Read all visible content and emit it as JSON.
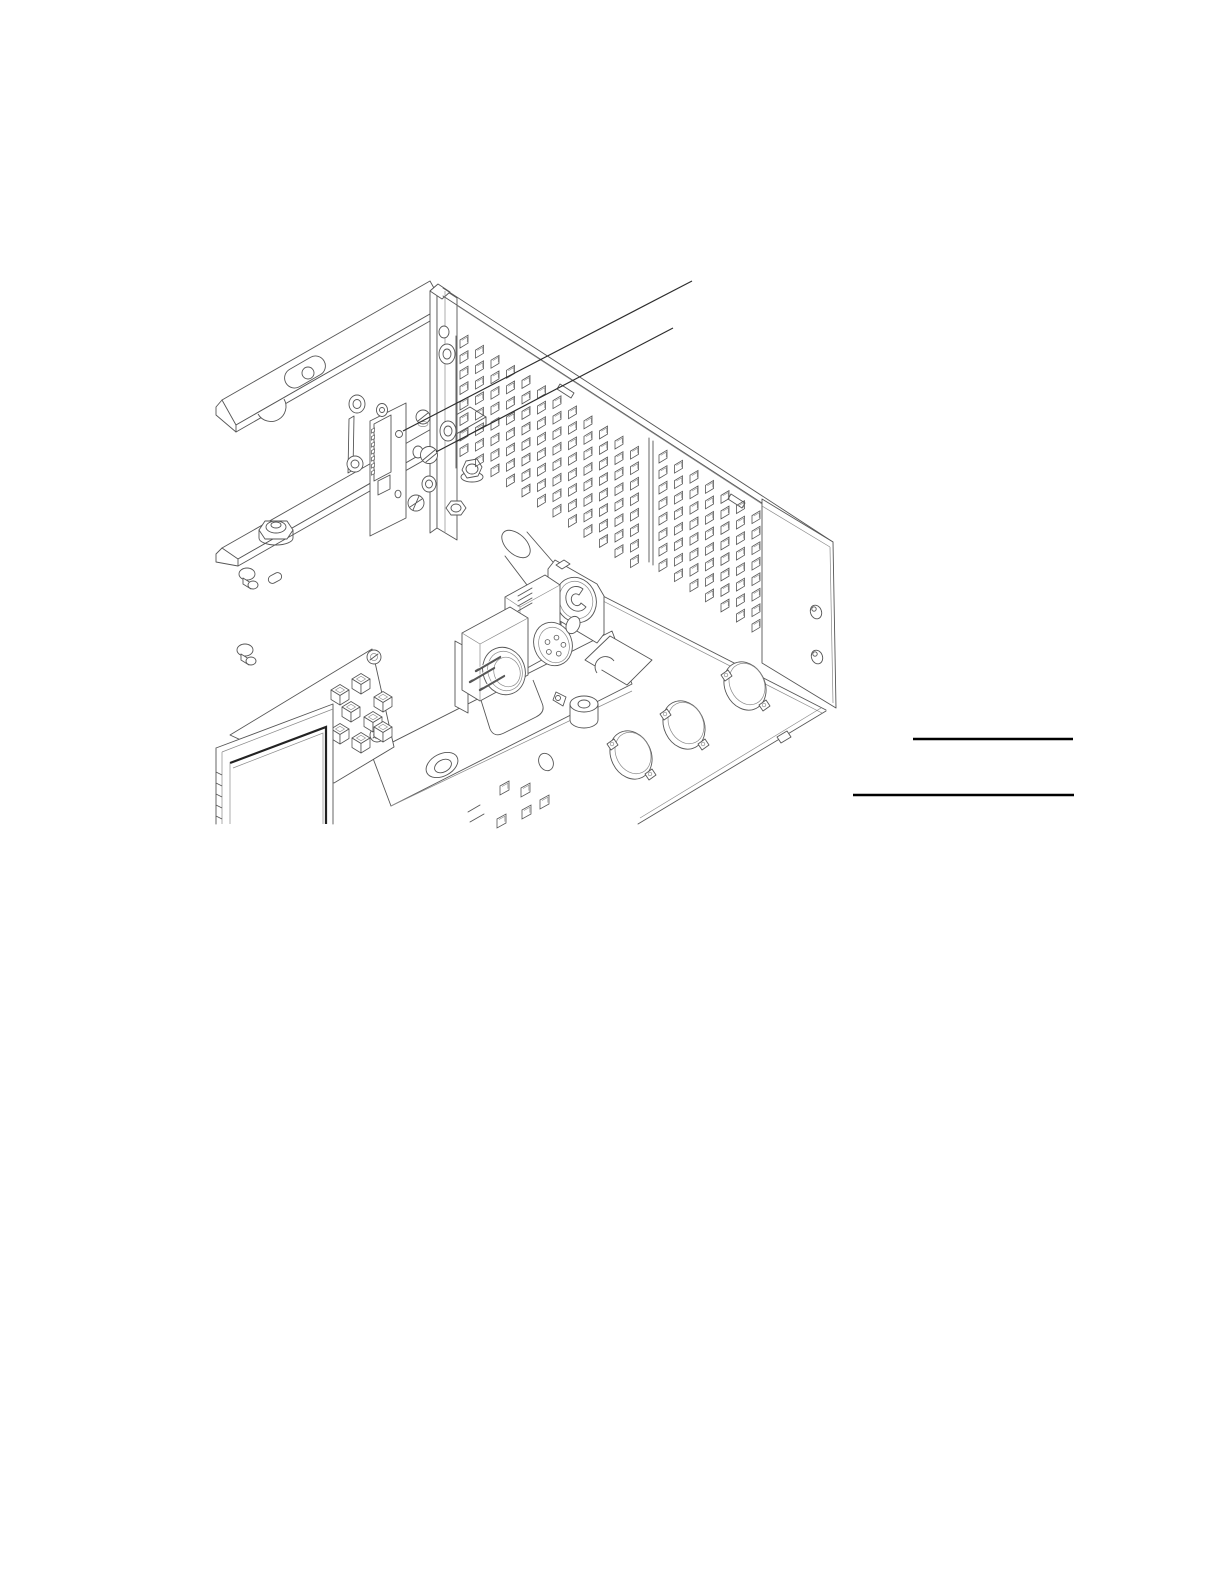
{
  "page": {
    "width": 1224,
    "height": 1584,
    "background": "#ffffff"
  },
  "figure": {
    "type": "isometric-line-illustration",
    "description": "Interior isometric view of an instrument chassis: rear bracket rails, small interface PCB with edge connector, perforated vent panels, right side panel, front panel with XLR cutouts, XLR connectors on a bracket, and a keypad/LCD display board. Two callout leader lines indicate a PCB hole and a mounting screw.",
    "colors": {
      "stroke": "#565656",
      "stroke_light": "#8a8a8a",
      "leader": "#2c2c2c",
      "rule": "#000000",
      "window_edge": "#222222"
    },
    "callouts": [
      {
        "id": "callout-1",
        "target": "pcb-hole",
        "from": [
          692,
          281
        ],
        "to": [
          403,
          431
        ]
      },
      {
        "id": "callout-2",
        "target": "mounting-screw",
        "from": [
          673,
          328
        ],
        "to": [
          436,
          452
        ]
      }
    ],
    "rules": [
      {
        "x1": 913,
        "x2": 1073,
        "y": 739,
        "thickness": 2.6
      },
      {
        "x1": 853,
        "x2": 1074,
        "y": 795,
        "thickness": 2.6
      }
    ],
    "vents": [
      {
        "id": "vent-panel-left",
        "x": 460,
        "y": 340,
        "cols": 12,
        "rows": 8,
        "dx": 15.5,
        "dy": 15.5,
        "col_shift": 10.1,
        "hole_w": 8,
        "hole_h": 8,
        "hole_rise": 4.8
      },
      {
        "id": "vent-panel-right",
        "x": 659,
        "y": 455,
        "cols": 9,
        "rows": 8,
        "dx": 15.5,
        "dy": 15.5,
        "col_shift": 10.1,
        "hole_w": 8,
        "hole_h": 8,
        "hole_rise": 4.8
      }
    ],
    "front_panel_squares": {
      "size": 9,
      "rise": 5,
      "positions": [
        [
          500,
          786
        ],
        [
          521,
          788
        ],
        [
          540,
          800
        ],
        [
          522,
          810
        ],
        [
          497,
          819
        ]
      ]
    },
    "keypad_switches": {
      "positions": [
        [
          340,
          690
        ],
        [
          361,
          679
        ],
        [
          383,
          697
        ],
        [
          351,
          707
        ],
        [
          373,
          717
        ],
        [
          340,
          729
        ],
        [
          361,
          738
        ],
        [
          383,
          727
        ]
      ]
    },
    "xlr_female_pinholes": {
      "center": [
        555,
        646
      ],
      "radius": 8.5,
      "hole_r": 2.4,
      "count": 5,
      "start_angle": -80,
      "step": 72
    },
    "xlr_male_pins": {
      "vector": [
        -24,
        14
      ],
      "starts": [
        [
          500,
          657
        ],
        [
          494,
          668
        ],
        [
          504,
          676
        ]
      ]
    },
    "edge_connector_teeth": {
      "count": 7,
      "x": 374.5,
      "y0": 428,
      "dy": 7
    },
    "lcd_edge_ticks": {
      "count": 5,
      "x": 216,
      "y0": 772,
      "dy": 11
    },
    "components": [
      "rear flange rail with slot and notch",
      "chassis floor rail",
      "hex standoff",
      "rivets",
      "corner post",
      "interface pcb with edge connector",
      "pcb hole (callout target)",
      "mounting screw (callout target)",
      "vent panel left",
      "vent panel right",
      "right side panel with screw holes",
      "front panel with xlr cutouts",
      "xlr square-flange panel connector",
      "xlr female 5-pin connector",
      "xlr male connector",
      "cable clamp",
      "notched mounting bracket",
      "rail with countersunk hole",
      "keypad pcb with tact switches",
      "lcd window"
    ]
  }
}
